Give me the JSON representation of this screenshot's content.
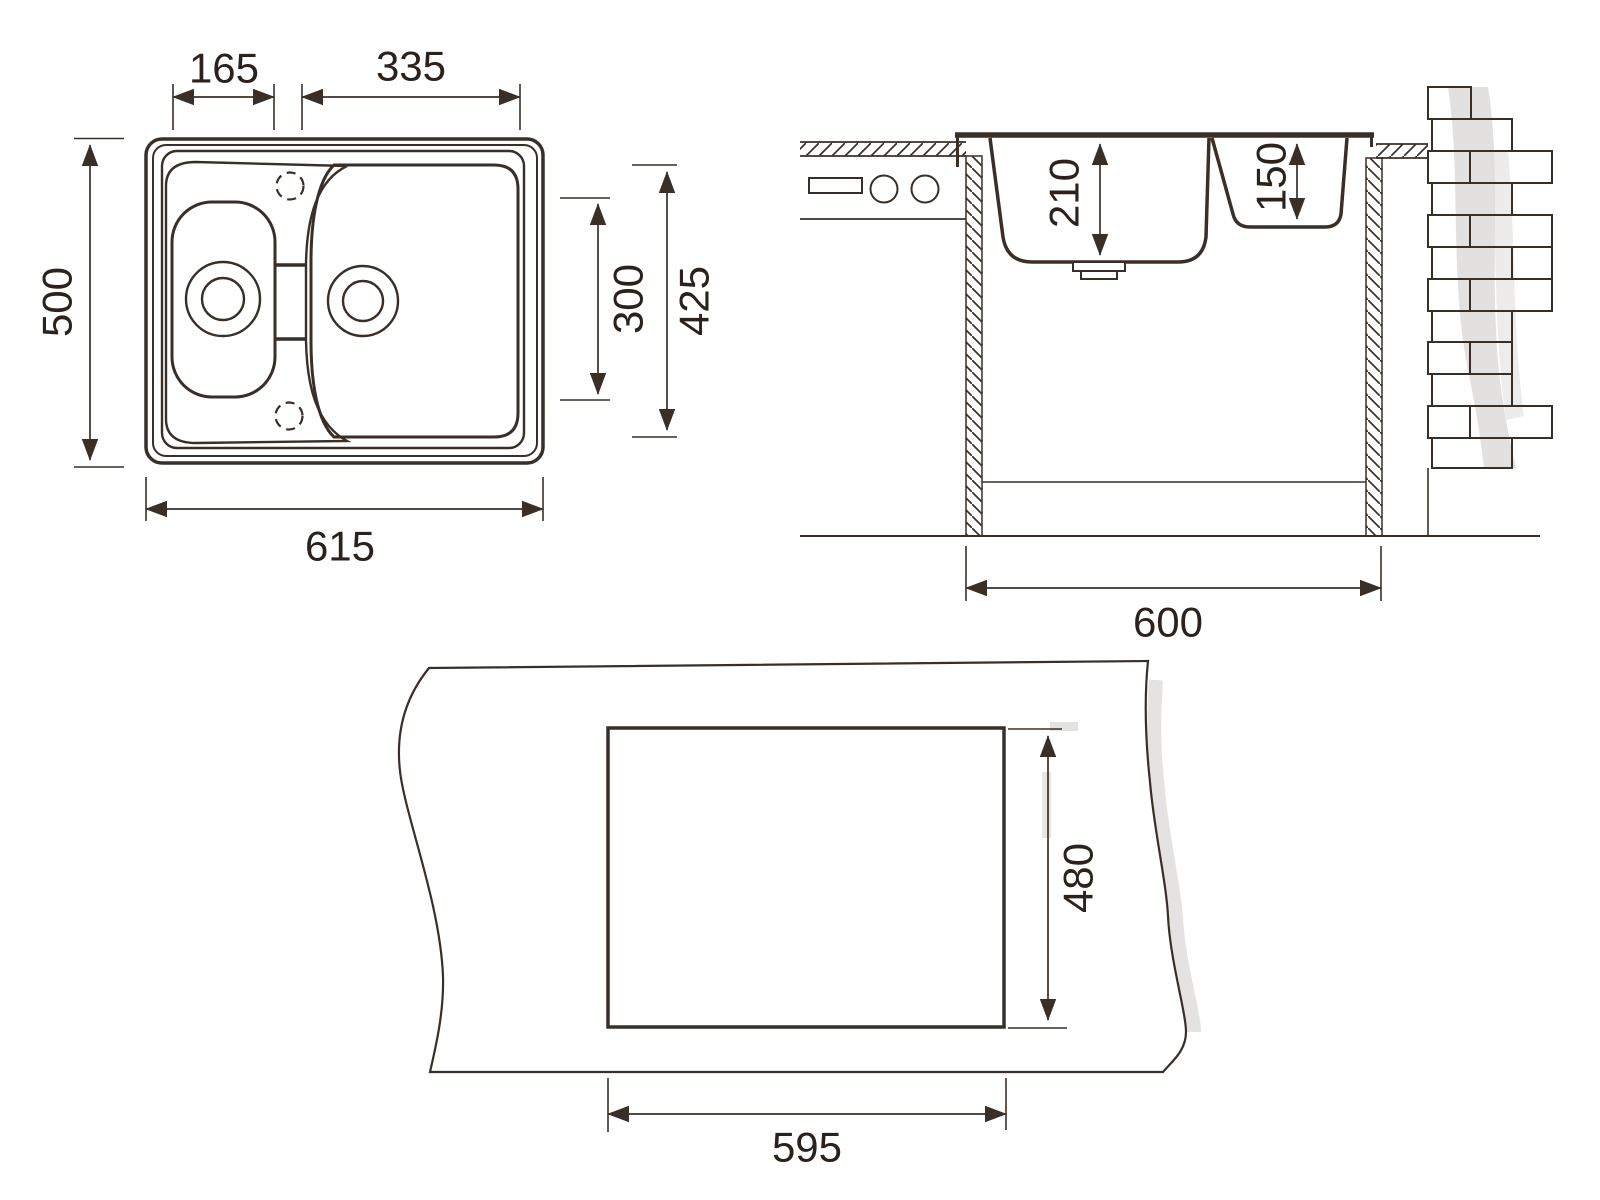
{
  "colors": {
    "line": "#3a2f26",
    "text": "#2b221b",
    "shadow": "#dedcd9",
    "background": "#ffffff"
  },
  "views": {
    "top_view": {
      "dims": {
        "small_bowl_width": "165",
        "main_bowl_width": "335",
        "overall_depth": "500",
        "overall_width": "615",
        "bowl_inner_depth": "300",
        "basin_depth": "425"
      }
    },
    "section_view": {
      "dims": {
        "main_bowl_depth": "210",
        "small_bowl_depth": "150",
        "cabinet_width": "600"
      }
    },
    "cutout_view": {
      "dims": {
        "cutout_depth": "480",
        "cutout_width": "595"
      }
    }
  }
}
